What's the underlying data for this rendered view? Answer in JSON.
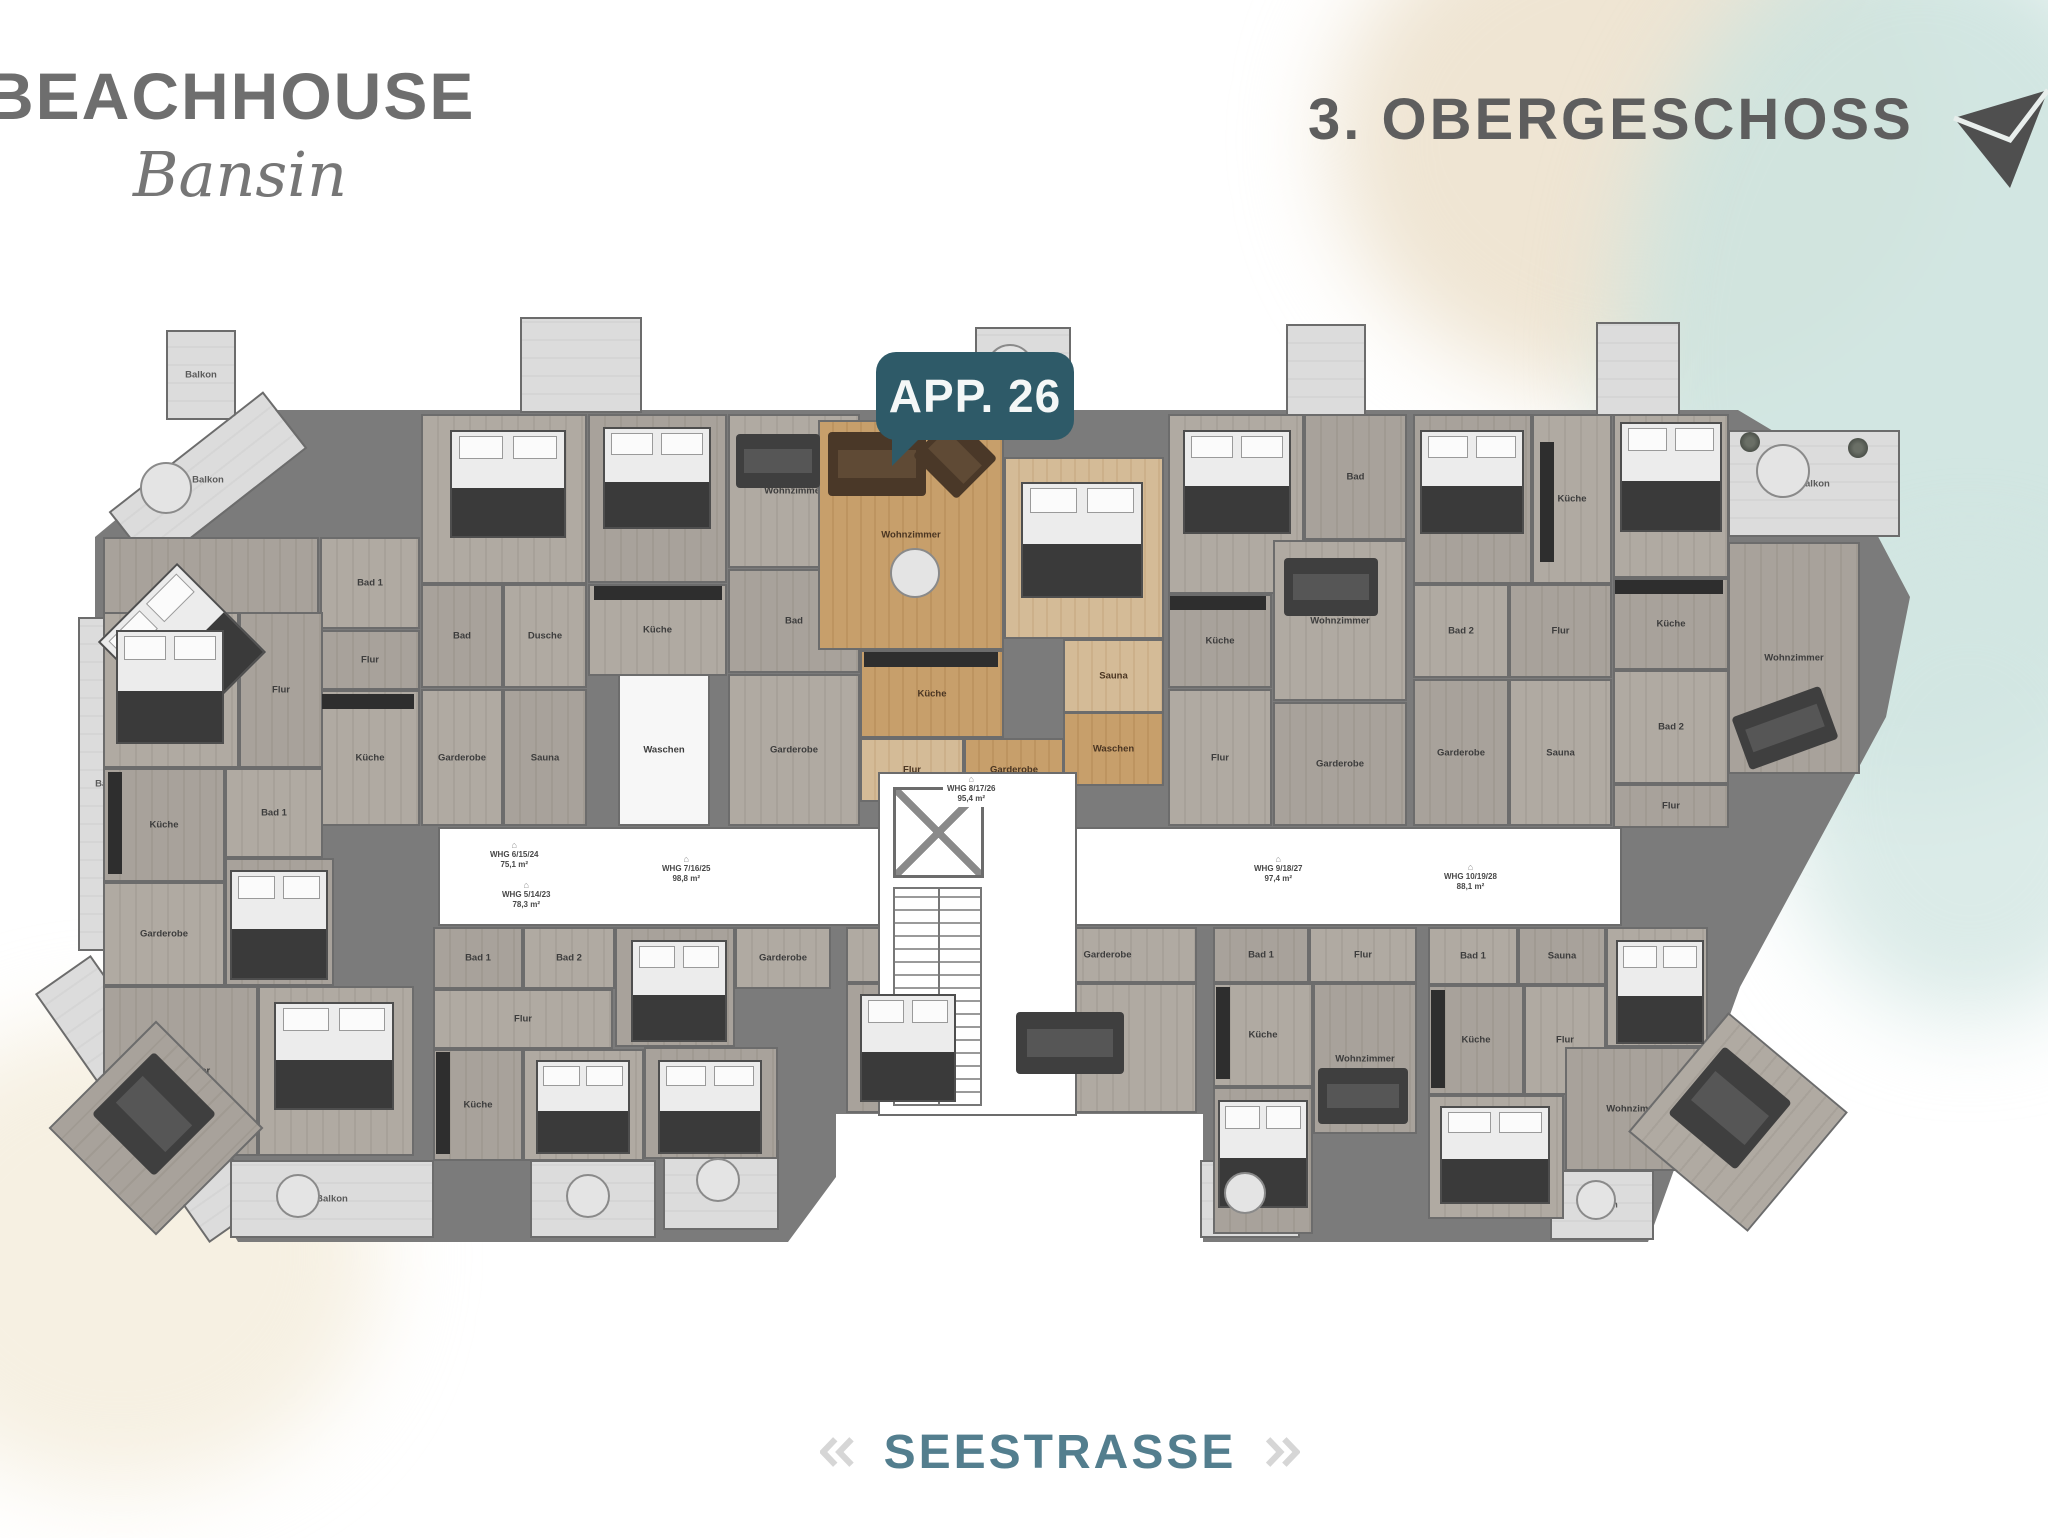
{
  "header": {
    "brand": "BEACHHOUSE",
    "brand_sub": "Bansin",
    "floor_title": "3. OBERGESCHOSS"
  },
  "badge": {
    "label": "APP. 26"
  },
  "streets": {
    "bottom": "SEESTRASSE",
    "left": "BERGSTRASSE"
  },
  "colors": {
    "badge_teal": "#2e5a68",
    "street_teal": "#537e8e",
    "title_gray": "#5e5e5e",
    "wall_gray": "#7b7b7b",
    "highlight_tan": "#c79f6b",
    "balcony_light": "#dcdcdc",
    "wash_teal": "#cde3df",
    "wash_beige": "#ece1cb"
  },
  "floorplan": {
    "corridor": {
      "x": 350,
      "y": 425,
      "w": 1180,
      "h": 95
    },
    "core": {
      "x": 790,
      "y": 370,
      "w": 195,
      "h": 340
    },
    "elevator": {
      "x": 805,
      "y": 385,
      "w": 85,
      "h": 85
    },
    "stairs": {
      "x": 805,
      "y": 485,
      "w": 85,
      "h": 215
    },
    "rooms": [
      {
        "l": "Balkon",
        "x": 78,
        "y": -72,
        "w": 66,
        "h": 86,
        "t": "light"
      },
      {
        "l": "Balkon",
        "x": 22,
        "y": 42,
        "w": 192,
        "h": 68,
        "t": "light",
        "r": -38
      },
      {
        "l": "",
        "x": 432,
        "y": -85,
        "w": 118,
        "h": 92,
        "t": "light"
      },
      {
        "l": "Balkon",
        "x": 887,
        "y": -75,
        "w": 92,
        "h": 95,
        "t": "light"
      },
      {
        "l": "",
        "x": 1198,
        "y": -78,
        "w": 76,
        "h": 88,
        "t": "light"
      },
      {
        "l": "",
        "x": 1508,
        "y": -80,
        "w": 80,
        "h": 90,
        "t": "light"
      },
      {
        "l": "Balkon",
        "x": 1640,
        "y": 28,
        "w": 168,
        "h": 103,
        "t": "light"
      },
      {
        "l": "Balkon",
        "x": -10,
        "y": 215,
        "w": 62,
        "h": 330,
        "t": "light"
      },
      {
        "l": "",
        "x": 28,
        "y": 545,
        "w": 64,
        "h": 300,
        "t": "light",
        "r": -35
      },
      {
        "l": "Balkon",
        "x": 142,
        "y": 758,
        "w": 200,
        "h": 74,
        "t": "light"
      },
      {
        "l": "Balkon",
        "x": 442,
        "y": 758,
        "w": 122,
        "h": 74,
        "t": "light"
      },
      {
        "l": "Balkon",
        "x": 575,
        "y": 738,
        "w": 112,
        "h": 86,
        "t": "light"
      },
      {
        "l": "Balkon",
        "x": 1112,
        "y": 758,
        "w": 96,
        "h": 74,
        "t": "light"
      },
      {
        "l": "Balkon",
        "x": 1462,
        "y": 768,
        "w": 100,
        "h": 66,
        "t": "light"
      },
      {
        "l": "Schlafzimmer",
        "x": 15,
        "y": 135,
        "w": 212,
        "h": 228,
        "t": "g1"
      },
      {
        "l": "Bad 1",
        "x": 232,
        "y": 135,
        "w": 96,
        "h": 88,
        "t": "g2"
      },
      {
        "l": "Flur",
        "x": 232,
        "y": 228,
        "w": 96,
        "h": 56,
        "t": "g1"
      },
      {
        "l": "Küche",
        "x": 232,
        "y": 288,
        "w": 96,
        "h": 132,
        "t": "g2"
      },
      {
        "l": "Schlafen 1",
        "x": 333,
        "y": 12,
        "w": 162,
        "h": 166,
        "t": "g2"
      },
      {
        "l": "Bad",
        "x": 333,
        "y": 182,
        "w": 78,
        "h": 100,
        "t": "g1"
      },
      {
        "l": "Dusche",
        "x": 415,
        "y": 182,
        "w": 80,
        "h": 100,
        "t": "g2"
      },
      {
        "l": "Garderobe",
        "x": 333,
        "y": 287,
        "w": 78,
        "h": 133,
        "t": "g2"
      },
      {
        "l": "Sauna",
        "x": 415,
        "y": 287,
        "w": 80,
        "h": 133,
        "t": "g1"
      },
      {
        "l": "Schlafen 2",
        "x": 500,
        "y": 12,
        "w": 135,
        "h": 165,
        "t": "g1"
      },
      {
        "l": "Wohnzimmer",
        "x": 640,
        "y": 12,
        "w": 128,
        "h": 150,
        "t": "g2"
      },
      {
        "l": "Küche",
        "x": 500,
        "y": 182,
        "w": 135,
        "h": 88,
        "t": "g2"
      },
      {
        "l": "Bad",
        "x": 640,
        "y": 167,
        "w": 128,
        "h": 100,
        "t": "g1"
      },
      {
        "l": "Waschen",
        "x": 530,
        "y": 272,
        "w": 88,
        "h": 148,
        "t": "white"
      },
      {
        "l": "Garderobe",
        "x": 640,
        "y": 272,
        "w": 128,
        "h": 148,
        "t": "g2"
      },
      {
        "l": "Wohnzimmer",
        "x": 730,
        "y": 18,
        "w": 182,
        "h": 226,
        "t": "tan"
      },
      {
        "l": "Schlafen",
        "x": 916,
        "y": 55,
        "w": 156,
        "h": 178,
        "t": "tanL"
      },
      {
        "l": "Küche",
        "x": 772,
        "y": 248,
        "w": 140,
        "h": 84,
        "t": "tan"
      },
      {
        "l": "Sauna",
        "x": 975,
        "y": 237,
        "w": 97,
        "h": 70,
        "t": "tanL"
      },
      {
        "l": "Waschen",
        "x": 975,
        "y": 310,
        "w": 97,
        "h": 70,
        "t": "tan"
      },
      {
        "l": "Flur",
        "x": 772,
        "y": 336,
        "w": 100,
        "h": 60,
        "t": "tanL"
      },
      {
        "l": "Garderobe",
        "x": 876,
        "y": 336,
        "w": 96,
        "h": 60,
        "t": "tan"
      },
      {
        "l": "Schlafen",
        "x": 1080,
        "y": 12,
        "w": 132,
        "h": 176,
        "t": "g2"
      },
      {
        "l": "Bad",
        "x": 1216,
        "y": 12,
        "w": 99,
        "h": 122,
        "t": "g1"
      },
      {
        "l": "Küche",
        "x": 1080,
        "y": 192,
        "w": 100,
        "h": 90,
        "t": "g1"
      },
      {
        "l": "Wohnzimmer",
        "x": 1185,
        "y": 138,
        "w": 130,
        "h": 157,
        "t": "g2"
      },
      {
        "l": "Flur",
        "x": 1080,
        "y": 287,
        "w": 100,
        "h": 133,
        "t": "g2"
      },
      {
        "l": "Garderobe",
        "x": 1185,
        "y": 300,
        "w": 130,
        "h": 120,
        "t": "g1"
      },
      {
        "l": "Schlafen 1",
        "x": 1325,
        "y": 12,
        "w": 115,
        "h": 166,
        "t": "g1"
      },
      {
        "l": "Küche",
        "x": 1444,
        "y": 12,
        "w": 76,
        "h": 166,
        "t": "g2"
      },
      {
        "l": "Bad 2",
        "x": 1325,
        "y": 182,
        "w": 92,
        "h": 90,
        "t": "g2"
      },
      {
        "l": "Flur",
        "x": 1421,
        "y": 182,
        "w": 99,
        "h": 90,
        "t": "g1"
      },
      {
        "l": "Garderobe",
        "x": 1325,
        "y": 277,
        "w": 92,
        "h": 143,
        "t": "g1"
      },
      {
        "l": "Sauna",
        "x": 1421,
        "y": 277,
        "w": 99,
        "h": 143,
        "t": "g2"
      },
      {
        "l": "Schlafen 2",
        "x": 1525,
        "y": 12,
        "w": 112,
        "h": 160,
        "t": "g2"
      },
      {
        "l": "Küche",
        "x": 1525,
        "y": 176,
        "w": 112,
        "h": 88,
        "t": "g1"
      },
      {
        "l": "Bad 2",
        "x": 1525,
        "y": 268,
        "w": 112,
        "h": 110,
        "t": "g2"
      },
      {
        "l": "Wohnzimmer",
        "x": 1640,
        "y": 140,
        "w": 128,
        "h": 228,
        "t": "g1"
      },
      {
        "l": "Flur",
        "x": 1525,
        "y": 382,
        "w": 112,
        "h": 40,
        "t": "g1"
      },
      {
        "l": "Schlafen 2",
        "x": 15,
        "y": 210,
        "w": 132,
        "h": 152,
        "t": "g2"
      },
      {
        "l": "Flur",
        "x": 151,
        "y": 210,
        "w": 80,
        "h": 152,
        "t": "g1"
      },
      {
        "l": "Küche",
        "x": 15,
        "y": 366,
        "w": 118,
        "h": 110,
        "t": "g1"
      },
      {
        "l": "Bad 1",
        "x": 137,
        "y": 366,
        "w": 94,
        "h": 86,
        "t": "g2"
      },
      {
        "l": "Schlafzimmer",
        "x": 137,
        "y": 456,
        "w": 105,
        "h": 124,
        "t": "g1"
      },
      {
        "l": "Garderobe",
        "x": 15,
        "y": 480,
        "w": 118,
        "h": 100,
        "t": "g2"
      },
      {
        "l": "Wohnzimmer",
        "x": 15,
        "y": 584,
        "w": 151,
        "h": 166,
        "t": "g1"
      },
      {
        "l": "Schlafen 1",
        "x": 170,
        "y": 584,
        "w": 152,
        "h": 166,
        "t": "g2"
      },
      {
        "l": "Bad 1",
        "x": 345,
        "y": 525,
        "w": 86,
        "h": 58,
        "t": "g1"
      },
      {
        "l": "Bad 2",
        "x": 435,
        "y": 525,
        "w": 88,
        "h": 58,
        "t": "g2"
      },
      {
        "l": "Schlafen 2",
        "x": 527,
        "y": 525,
        "w": 116,
        "h": 116,
        "t": "g1"
      },
      {
        "l": "Garderobe",
        "x": 647,
        "y": 525,
        "w": 92,
        "h": 58,
        "t": "g2"
      },
      {
        "l": "Flur",
        "x": 345,
        "y": 587,
        "w": 176,
        "h": 56,
        "t": "g2"
      },
      {
        "l": "Küche",
        "x": 345,
        "y": 647,
        "w": 86,
        "h": 108,
        "t": "g1"
      },
      {
        "l": "Schlafen 1",
        "x": 435,
        "y": 647,
        "w": 117,
        "h": 108,
        "t": "g2"
      },
      {
        "l": "Schlafzimmer",
        "x": 556,
        "y": 645,
        "w": 130,
        "h": 108,
        "t": "g1"
      },
      {
        "l": "Bad 2",
        "x": 758,
        "y": 525,
        "w": 86,
        "h": 52,
        "t": "g2"
      },
      {
        "l": "Sauna",
        "x": 848,
        "y": 525,
        "w": 78,
        "h": 52,
        "t": "g1"
      },
      {
        "l": "Garderobe",
        "x": 930,
        "y": 525,
        "w": 175,
        "h": 52,
        "t": "g2"
      },
      {
        "l": "Schlafen 2",
        "x": 758,
        "y": 581,
        "w": 118,
        "h": 126,
        "t": "g1"
      },
      {
        "l": "Wohnzimmer",
        "x": 880,
        "y": 581,
        "w": 225,
        "h": 126,
        "t": "g2"
      },
      {
        "l": "Bad 1",
        "x": 1125,
        "y": 525,
        "w": 92,
        "h": 52,
        "t": "g1"
      },
      {
        "l": "Flur",
        "x": 1221,
        "y": 525,
        "w": 104,
        "h": 52,
        "t": "g2"
      },
      {
        "l": "Küche",
        "x": 1125,
        "y": 581,
        "w": 96,
        "h": 100,
        "t": "g2"
      },
      {
        "l": "Wohnzimmer",
        "x": 1225,
        "y": 581,
        "w": 100,
        "h": 147,
        "t": "g1"
      },
      {
        "l": "Schlafen 1",
        "x": 1125,
        "y": 685,
        "w": 96,
        "h": 143,
        "t": "g1"
      },
      {
        "l": "Bad 1",
        "x": 1340,
        "y": 525,
        "w": 86,
        "h": 54,
        "t": "g2"
      },
      {
        "l": "Sauna",
        "x": 1430,
        "y": 525,
        "w": 84,
        "h": 54,
        "t": "g1"
      },
      {
        "l": "Schlafen 2",
        "x": 1518,
        "y": 525,
        "w": 98,
        "h": 116,
        "t": "g2"
      },
      {
        "l": "Küche",
        "x": 1340,
        "y": 583,
        "w": 92,
        "h": 106,
        "t": "g1"
      },
      {
        "l": "Flur",
        "x": 1436,
        "y": 583,
        "w": 78,
        "h": 106,
        "t": "g2"
      },
      {
        "l": "Wohnzimmer",
        "x": 1477,
        "y": 645,
        "w": 138,
        "h": 120,
        "t": "g1"
      },
      {
        "l": "Schlafen 1",
        "x": 1340,
        "y": 693,
        "w": 132,
        "h": 120,
        "t": "g2"
      },
      {
        "l": "Wohnzimmer",
        "x": -8,
        "y": 650,
        "w": 148,
        "h": 148,
        "t": "g1",
        "r": 45
      },
      {
        "l": "Wohnzimmer",
        "x": 1572,
        "y": 642,
        "w": 152,
        "h": 152,
        "t": "g2",
        "r": 40
      }
    ],
    "whg_labels": [
      {
        "t1": "WHG 6/15/24",
        "t2": "75,1 m²",
        "x": 398,
        "y": 438
      },
      {
        "t1": "WHG 5/14/23",
        "t2": "78,3 m²",
        "x": 410,
        "y": 478
      },
      {
        "t1": "WHG 7/16/25",
        "t2": "98,8 m²",
        "x": 570,
        "y": 452
      },
      {
        "t1": "WHG 8/17/26",
        "t2": "95,4 m²",
        "x": 855,
        "y": 372
      },
      {
        "t1": "WHG 9/18/27",
        "t2": "97,4 m²",
        "x": 1162,
        "y": 452
      },
      {
        "t1": "WHG 10/19/28",
        "t2": "88,1 m²",
        "x": 1352,
        "y": 460
      }
    ],
    "beds": [
      [
        38,
        182,
        108,
        122,
        -45
      ],
      [
        362,
        28,
        112,
        104,
        0
      ],
      [
        515,
        25,
        104,
        98,
        0
      ],
      [
        933,
        80,
        118,
        112,
        0
      ],
      [
        1095,
        28,
        104,
        100,
        0
      ],
      [
        1332,
        28,
        100,
        100,
        0
      ],
      [
        1532,
        20,
        98,
        106,
        0
      ],
      [
        28,
        228,
        104,
        110,
        0
      ],
      [
        142,
        468,
        94,
        106,
        0
      ],
      [
        186,
        600,
        116,
        104,
        0
      ],
      [
        543,
        538,
        92,
        98,
        0
      ],
      [
        448,
        658,
        90,
        90,
        0
      ],
      [
        570,
        658,
        100,
        90,
        0
      ],
      [
        772,
        592,
        92,
        104,
        0
      ],
      [
        1130,
        698,
        86,
        104,
        0
      ],
      [
        1528,
        538,
        84,
        100,
        0
      ],
      [
        1352,
        704,
        106,
        94,
        0
      ]
    ],
    "sofas": [
      [
        648,
        32,
        84,
        54,
        0,
        "d"
      ],
      [
        740,
        30,
        98,
        64,
        0,
        "b"
      ],
      [
        836,
        26,
        62,
        58,
        45,
        "b"
      ],
      [
        1196,
        156,
        94,
        58,
        0,
        "d"
      ],
      [
        1650,
        298,
        94,
        56,
        -20,
        "d"
      ],
      [
        928,
        610,
        108,
        62,
        0,
        "d"
      ],
      [
        1230,
        666,
        90,
        56,
        0,
        "d"
      ],
      [
        22,
        668,
        88,
        88,
        45,
        "d"
      ],
      [
        1598,
        662,
        88,
        88,
        40,
        "d"
      ]
    ],
    "counters": [
      [
        234,
        292,
        92,
        15
      ],
      [
        506,
        184,
        128,
        14
      ],
      [
        776,
        250,
        134,
        15
      ],
      [
        1082,
        194,
        96,
        14
      ],
      [
        1452,
        40,
        14,
        120
      ],
      [
        1527,
        178,
        108,
        14
      ],
      [
        20,
        370,
        14,
        102
      ],
      [
        348,
        650,
        14,
        102
      ],
      [
        1128,
        585,
        14,
        92
      ],
      [
        1343,
        588,
        14,
        98
      ]
    ],
    "tables": [
      [
        52,
        60,
        48
      ],
      [
        898,
        -58,
        44
      ],
      [
        1668,
        42,
        50
      ],
      [
        802,
        146,
        46
      ],
      [
        478,
        772,
        40
      ],
      [
        608,
        756,
        40
      ],
      [
        1136,
        770,
        38
      ],
      [
        1488,
        778,
        36
      ],
      [
        188,
        772,
        40
      ]
    ],
    "plants": [
      [
        1652,
        30,
        20
      ],
      [
        1760,
        36,
        20
      ]
    ]
  }
}
